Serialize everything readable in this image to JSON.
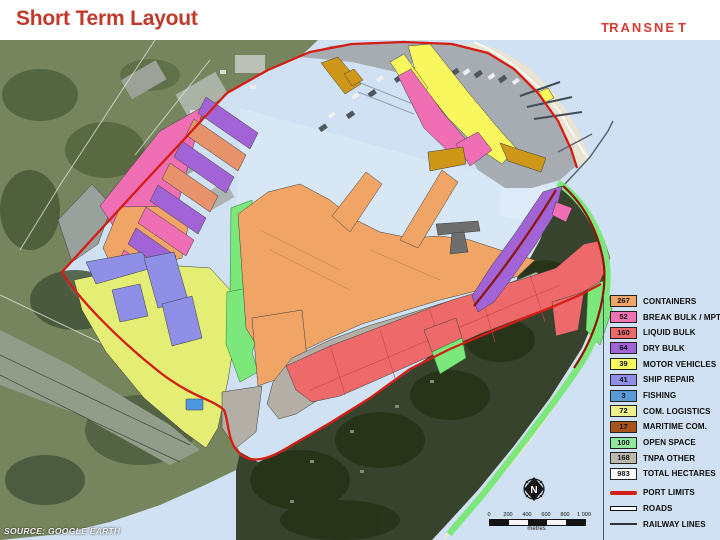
{
  "header": {
    "title": "Short Term Layout",
    "logo_text": "TRANSNET"
  },
  "map": {
    "source_note": "SOURCE:  GOOGLE EARTH",
    "north_label": "N",
    "scale_bar": {
      "tick_labels": [
        "0",
        "200",
        "400",
        "600",
        "800",
        "1 000"
      ],
      "unit_label": "metres"
    },
    "legend": {
      "area_items": [
        {
          "value": "267",
          "label": "CONTAINERS",
          "color": "#f0a566"
        },
        {
          "value": "52",
          "label": "BREAK BULK / MPT",
          "color": "#f272b2"
        },
        {
          "value": "160",
          "label": "LIQUID BULK",
          "color": "#ee6a6a"
        },
        {
          "value": "64",
          "label": "DRY BULK",
          "color": "#a163d6"
        },
        {
          "value": "39",
          "label": "MOTOR VEHICLES",
          "color": "#f8f85e"
        },
        {
          "value": "41",
          "label": "SHIP REPAIR",
          "color": "#8f8fe8"
        },
        {
          "value": "3",
          "label": "FISHING",
          "color": "#5b9bd5"
        },
        {
          "value": "72",
          "label": "COM. LOGISTICS",
          "color": "#eef08c"
        },
        {
          "value": "17",
          "label": "MARITIME COM.",
          "color": "#a9541b"
        },
        {
          "value": "100",
          "label": "OPEN SPACE",
          "color": "#8fe89f"
        },
        {
          "value": "168",
          "label": "TNPA OTHER",
          "color": "#bdb8ac"
        },
        {
          "value": "983",
          "label": "TOTAL HECTARES",
          "color": "#ffffff"
        }
      ],
      "line_items": [
        {
          "label": "PORT LIMITS",
          "style": "port-limits",
          "color": "#d41d14"
        },
        {
          "label": "ROADS",
          "style": "roads",
          "color": "#ffffff"
        },
        {
          "label": "RAILWAY LINES",
          "style": "railway",
          "color": "#333333"
        }
      ]
    },
    "colors": {
      "water": "#cfe1f2",
      "channel": "#e2eefa",
      "terrain_green": "#76855e",
      "bluff_green": "#37432c",
      "urban_gray": "#a6acb2",
      "port_limit_red": "#d41d14",
      "maroon_band": "#8a1708"
    }
  }
}
